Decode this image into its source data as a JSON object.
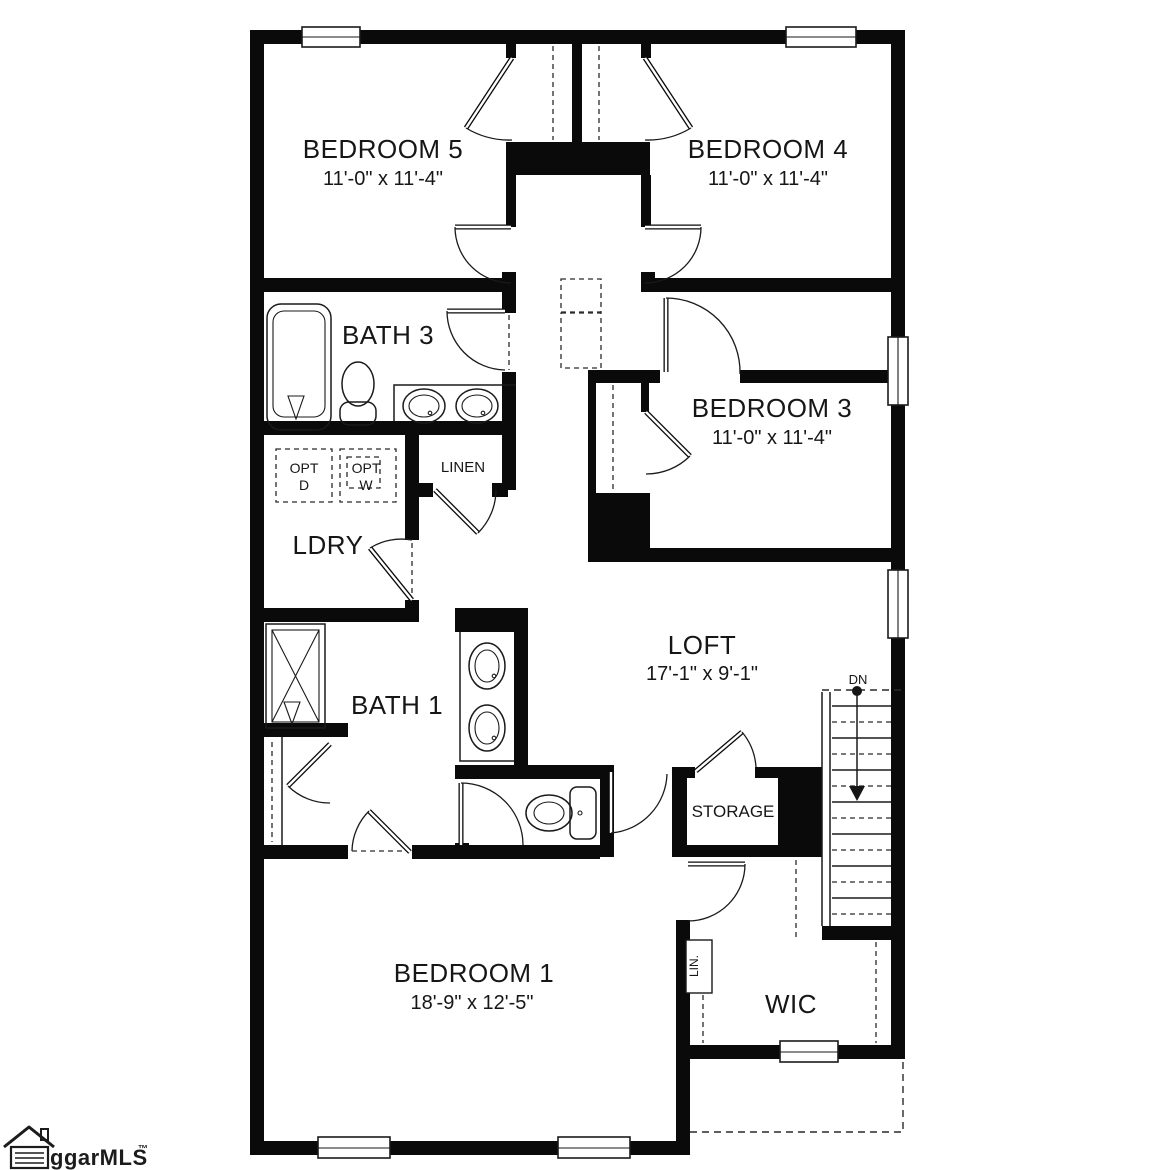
{
  "plan": {
    "rooms": {
      "bedroom5": {
        "name": "BEDROOM 5",
        "dims": "11'-0\" x 11'-4\""
      },
      "bedroom4": {
        "name": "BEDROOM 4",
        "dims": "11'-0\" x 11'-4\""
      },
      "bedroom3": {
        "name": "BEDROOM 3",
        "dims": "11'-0\" x 11'-4\""
      },
      "bath3": {
        "name": "BATH 3"
      },
      "ldry": {
        "name": "LDRY"
      },
      "linen": {
        "name": "LINEN"
      },
      "loft": {
        "name": "LOFT",
        "dims": "17'-1\" x 9'-1\""
      },
      "bath1": {
        "name": "BATH 1"
      },
      "storage": {
        "name": "STORAGE"
      },
      "bedroom1": {
        "name": "BEDROOM 1",
        "dims": "18'-9\" x 12'-5\""
      },
      "wic": {
        "name": "WIC"
      },
      "lin_closet": {
        "name": "LIN."
      }
    },
    "annotations": {
      "opt_d": {
        "line1": "OPT",
        "line2": "D"
      },
      "opt_w": {
        "line1": "OPT",
        "line2": "W"
      },
      "stairs_down": "DN"
    },
    "logo": {
      "text": "ggarMLS",
      "trademark": "™"
    },
    "colors": {
      "wall": "#0a0a0a",
      "line": "#1a1a1a",
      "background": "#ffffff"
    }
  }
}
